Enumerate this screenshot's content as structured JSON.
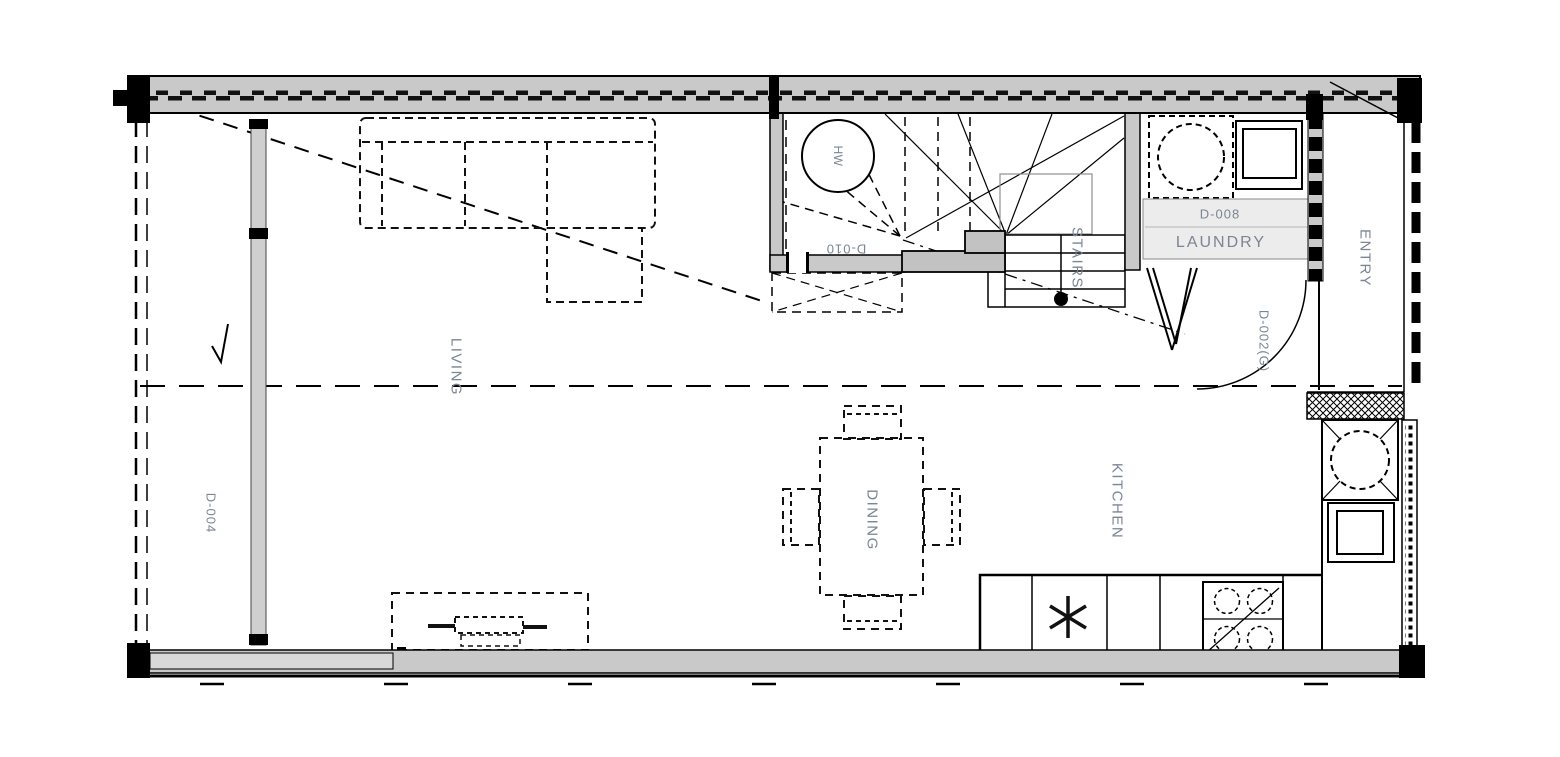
{
  "labels": {
    "living": "LIVING",
    "dining": "DINING",
    "kitchen": "KITCHEN",
    "entry": "ENTRY",
    "stairs": "STAIRS",
    "laundry": "LAUNDRY",
    "hot_water": "HW",
    "door_d004": "D-004",
    "door_d010": "D-010",
    "door_d008": "D-008",
    "door_d002": "D-002(G)"
  },
  "colors": {
    "label": "#7b8593",
    "wall_fill": "#c9c9c9",
    "bench_fill": "#ececec",
    "line": "#111111",
    "background": "#ffffff"
  }
}
